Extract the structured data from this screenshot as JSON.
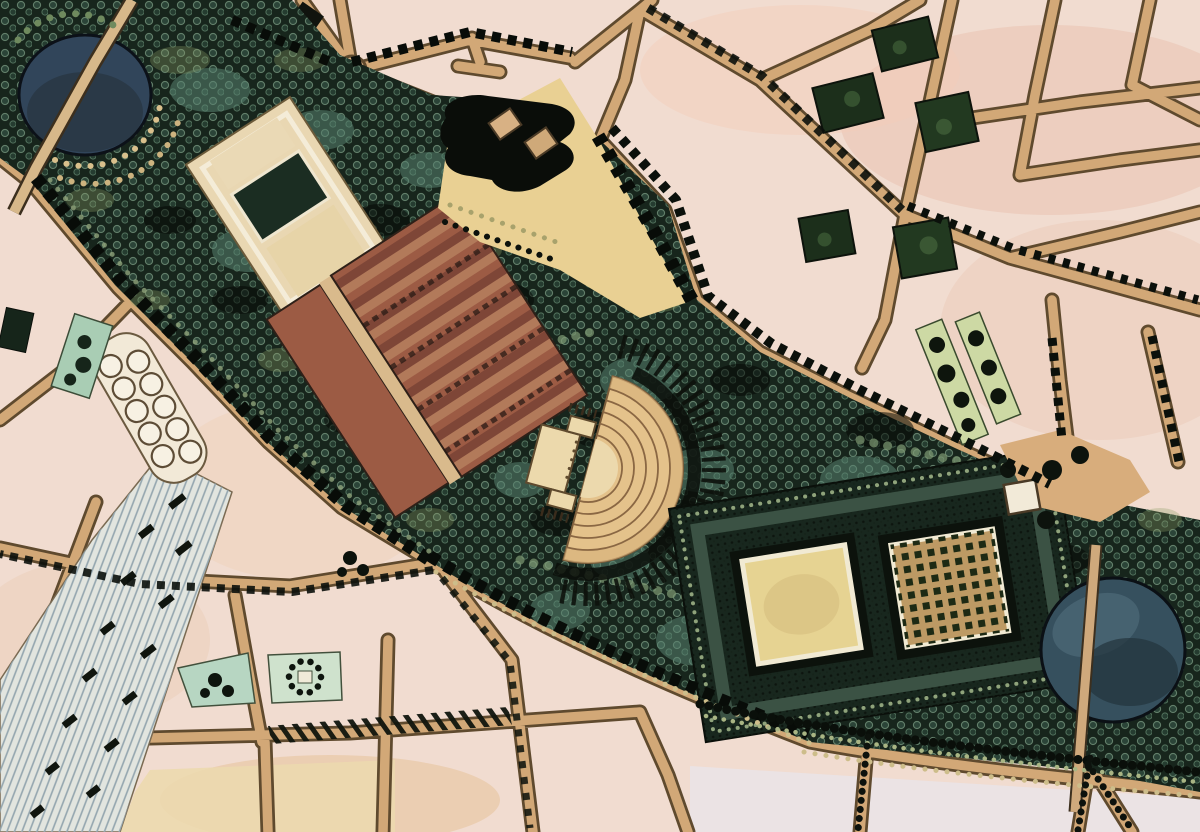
{
  "scene": {
    "type": "map-illustration",
    "description": "Hand-drawn aerial master plan: a diagonal park with oval pond, parterre, terraced gardens, semicircular amphitheatre, formal garden squares and circular basin, cutting through pink-toned city blocks with tan streets, tree-lined avenues and a railway yard fanning to the lower left."
  },
  "palette": {
    "paper": "#f1dcd0",
    "paper_rose": "#e9c2b0",
    "paper_cream": "#f5e8d6",
    "paper_cool": "#eae4e8",
    "block_yellow": "#ecd9ae",
    "plaza_yellow": "#e9d093",
    "street_fill": "#d2a877",
    "street_line": "#5f4a2e",
    "park_base": "#17251c",
    "tree_teal": "#57816f",
    "tree_khaki": "#8e9e66",
    "shadow_black": "#070b07",
    "pond_water": "#31455a",
    "basin_water": "#36505e",
    "terrace_rust": "#9c5b44",
    "terrace_rust_light": "#b27a5a",
    "amphitheatre_tan": "#e4c28b",
    "amphitheatre_line": "#8a6743",
    "stage_cream": "#ecd9ac",
    "lawn_square": "#e6d392",
    "bosquet_base": "#bd9a64",
    "rail_base": "#e2e5df",
    "rail_line": "#93a5ae",
    "parcel_green": "#b7d6c2",
    "parcel_dark": "#1c2f1b",
    "strip_green": "#cdd9a4",
    "path_cream": "#f2ead8",
    "dot_khaki": "#cdbd8a"
  },
  "features": [
    "city-street-network",
    "railway-yard",
    "circle-pavilion-row",
    "oval-pond",
    "parterre-garden",
    "terraced-garden",
    "entry-plaza",
    "entry-pavilion-building",
    "amphitheatre",
    "formal-garden",
    "lawn-square",
    "bosquet-square",
    "circular-basin",
    "garden-entrance-plaza",
    "green-strips",
    "city-square-parcels",
    "park-canopy",
    "tree-lined-avenues",
    "roundabout"
  ]
}
